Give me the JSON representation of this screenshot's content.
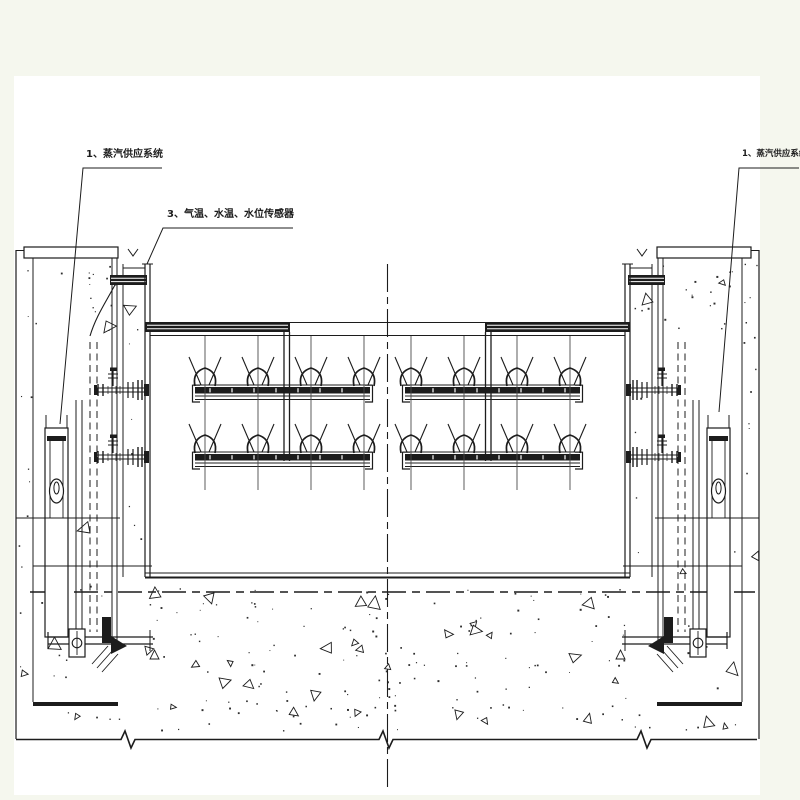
{
  "page": {
    "type": "engineering-section-drawing",
    "background": "#ffffff",
    "margin_color": "#f5f7ee",
    "line_color": "#1c1c1c"
  },
  "annotations": {
    "left_steam_label": "1、蒸汽供应系统",
    "sensor_label": "3、气温、水温、水位传感器",
    "right_steam_label": "1、蒸汽供应系统"
  }
}
